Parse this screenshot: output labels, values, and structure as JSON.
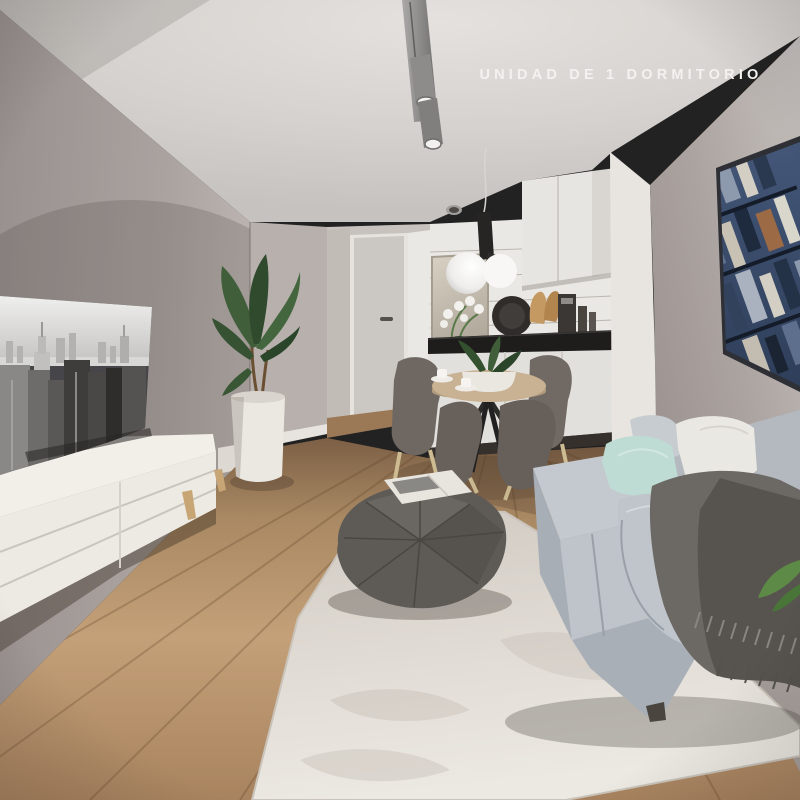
{
  "title": {
    "label": "UNIDAD DE 1 DORMITORIO"
  },
  "palette": {
    "title_text": "#f4f2f0",
    "ceiling": "#d6d2cf",
    "wall_left_dark": "#9a9290",
    "wall_corner": "#b7b0ad",
    "wall_right": "#aba3a0",
    "hall_wall": "#c7c2bd",
    "door": "#cbc7c3",
    "door_handle": "#55504c",
    "tile": "#eae8e4",
    "cabinet_upper": "#e7e5e1",
    "cabinet_lower": "#e2e0dc",
    "counter": "#1f1d1c",
    "end_panel": "#e8e5e1",
    "rug": "#ded9d2",
    "console": "#edeae3",
    "leg_wood": "#c7a574",
    "tv_frame": "#45454a",
    "sofa": "#bfc4cb",
    "sofa_base": "#a9afb7",
    "pillow_white": "#eae8e3",
    "pillow_mint": "#bedcd3",
    "pillow_gray": "#c7ccd1",
    "throw": "#6c6863",
    "pouf": "#5e5a56",
    "table_top": "#c9b294",
    "chair": "#6e6762",
    "plant": "#3f5e39",
    "pot": "#ebe8e2",
    "pendant": "#262524",
    "globe": "#f5f4f2",
    "track_light": "#8d8c8a",
    "art_frame": "#2e3035",
    "art_city": "#3b5071",
    "magazine": "#e8e5df"
  }
}
